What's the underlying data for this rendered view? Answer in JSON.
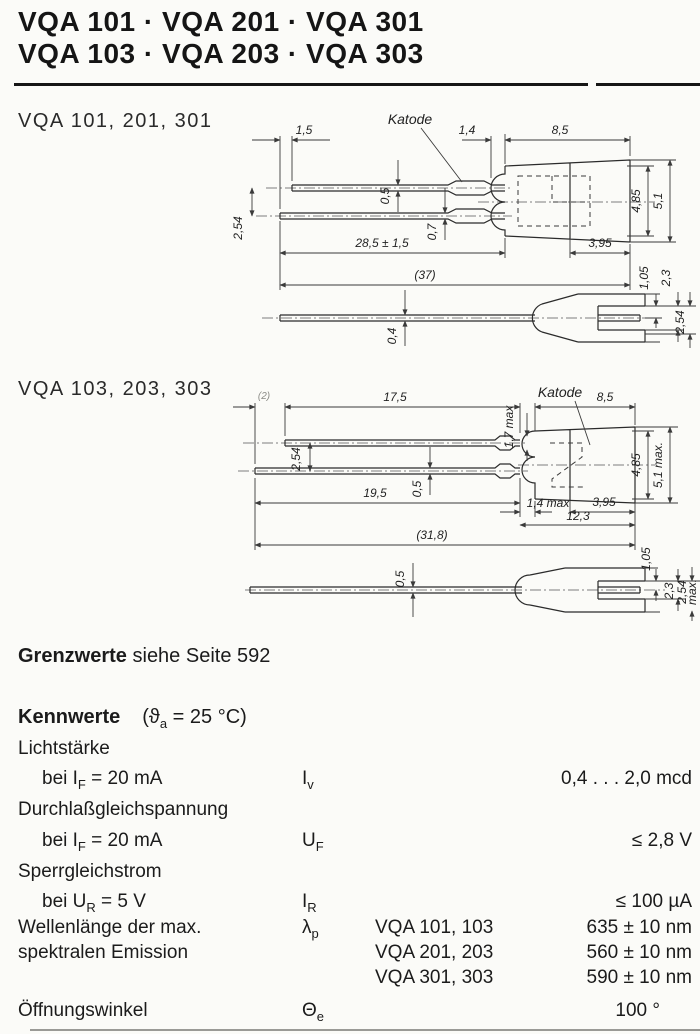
{
  "header": {
    "line1": "VQA 101 · VQA 201 · VQA 301",
    "line2": "VQA 103 · VQA 203 · VQA 303"
  },
  "fig1": {
    "label": "VQA 101, 201, 301",
    "katode": "Katode",
    "dims": {
      "d1_5": "1,5",
      "d1_4": "1,4",
      "d8_5": "8,5",
      "d0_5": "0,5",
      "d0_7": "0,7",
      "d2_54": "2,54",
      "d28_5": "28,5 ± 1,5",
      "d37": "(37)",
      "d3_95": "3,95",
      "d4_85": "4,85",
      "d5_1": "5,1",
      "d1_05": "1,05",
      "d2_3": "2,3",
      "d2_54b": "2,54",
      "d0_4": "0,4"
    }
  },
  "fig2": {
    "label": "VQA 103, 203, 303",
    "katode": "Katode",
    "dims": {
      "d2": "(2)",
      "d17_5": "17,5",
      "d1_7": "1,7 max",
      "d8_5": "8,5",
      "d2_54": "2,54",
      "d0_5": "0,5",
      "d19_5": "19,5",
      "d1_4": "1,4 max",
      "d3_95": "3,95",
      "d12_3": "12,3",
      "d31_8": "(31,8)",
      "d4_85": "4,85",
      "d5_1": "5,1 max.",
      "d0_5b": "0,5",
      "d1_05": "1,05",
      "d2_3": "2,3",
      "d2_54b": "2,54",
      "dmax": "max."
    }
  },
  "grenzwerte": {
    "bold": "Grenzwerte",
    "rest": " siehe Seite 592"
  },
  "kennwerte": {
    "heading": "Kennwerte",
    "cond_pre": "(ϑ",
    "cond_sub": "a",
    "cond_post": " = 25 °C)",
    "licht": {
      "group": "Lichtstärke",
      "bei_pre": "bei I",
      "bei_sub": "F",
      "bei_post": " = 20 mA",
      "sym": "I",
      "sym_sub": "v",
      "value": "0,4 . . . 2,0 mcd"
    },
    "durchlass": {
      "group": "Durchlaßgleichspannung",
      "bei_pre": "bei I",
      "bei_sub": "F",
      "bei_post": " = 20 mA",
      "sym": "U",
      "sym_sub": "F",
      "value": "≤ 2,8 V"
    },
    "sperr": {
      "group": "Sperrgleichstrom",
      "bei_pre": "bei U",
      "bei_sub": "R",
      "bei_post": " = 5 V",
      "sym": "I",
      "sym_sub": "R",
      "value": "≤ 100 µA"
    },
    "welle": {
      "name1": "Wellenlänge der max.",
      "name2": "spektralen Emission",
      "sym": "λ",
      "sym_sub": "p",
      "rows": [
        {
          "type": "VQA 101, 103",
          "value": "635 ± 10 nm"
        },
        {
          "type": "VQA 201, 203",
          "value": "560 ± 10 nm"
        },
        {
          "type": "VQA 301, 303",
          "value": "590 ± 10 nm"
        }
      ]
    },
    "oeff": {
      "name": "Öffnungswinkel",
      "sym": "Θ",
      "sym_sub": "e",
      "value": "100 °"
    }
  }
}
